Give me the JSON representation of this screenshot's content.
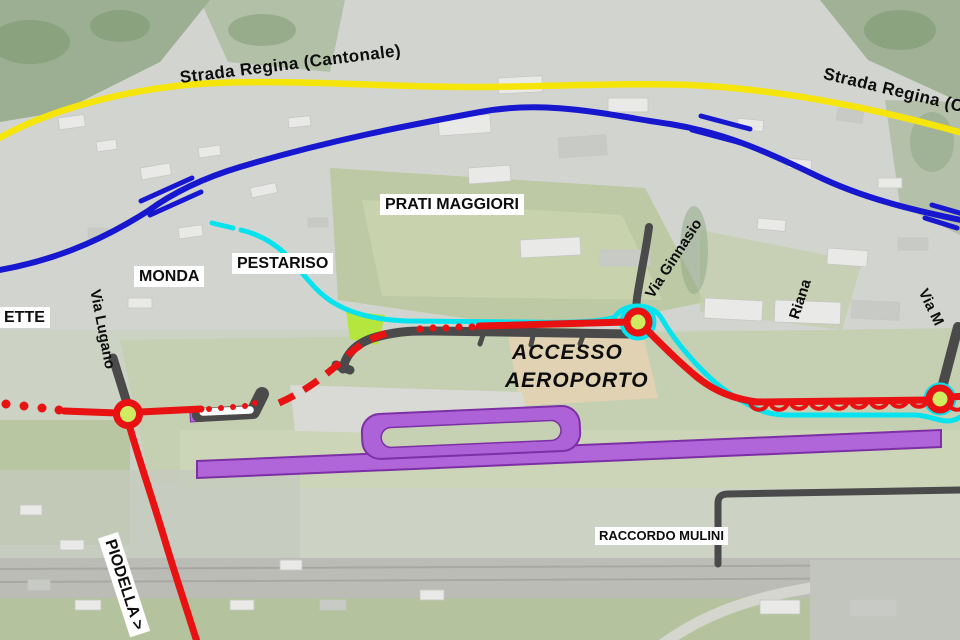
{
  "map": {
    "labels": {
      "strada_regina_west": "Strada Regina (Cantonale)",
      "strada_regina_east": "Strada Regina (Cantonale)",
      "prati_maggiori": "PRATI MAGGIORI",
      "pestariso": "PESTARISO",
      "monda": "MONDA",
      "ette": "ETTE",
      "via_lugano": "Via Lugano",
      "via_ginnasio": "Via Ginnasio",
      "riana": "Riana",
      "via_m": "Via M",
      "accesso_line1": "ACCESSO",
      "accesso_line2": "AEROPORTO",
      "raccordo_mulini": "RACCORDO MULINI",
      "piodella": "PIODELLA >"
    },
    "colors": {
      "cantonal_road_yellow": "#f6e50a",
      "blue_route": "#1717cf",
      "cycle_path_cyan": "#06e3ef",
      "project_road_red": "#e81212",
      "existing_road_gray": "#4a4a4a",
      "runway_purple": "#ae62d8",
      "runway_border_purple": "#7d2fa5",
      "roundabout_center_green": "#cfeb60",
      "green_patch": "#b4e63d"
    }
  }
}
